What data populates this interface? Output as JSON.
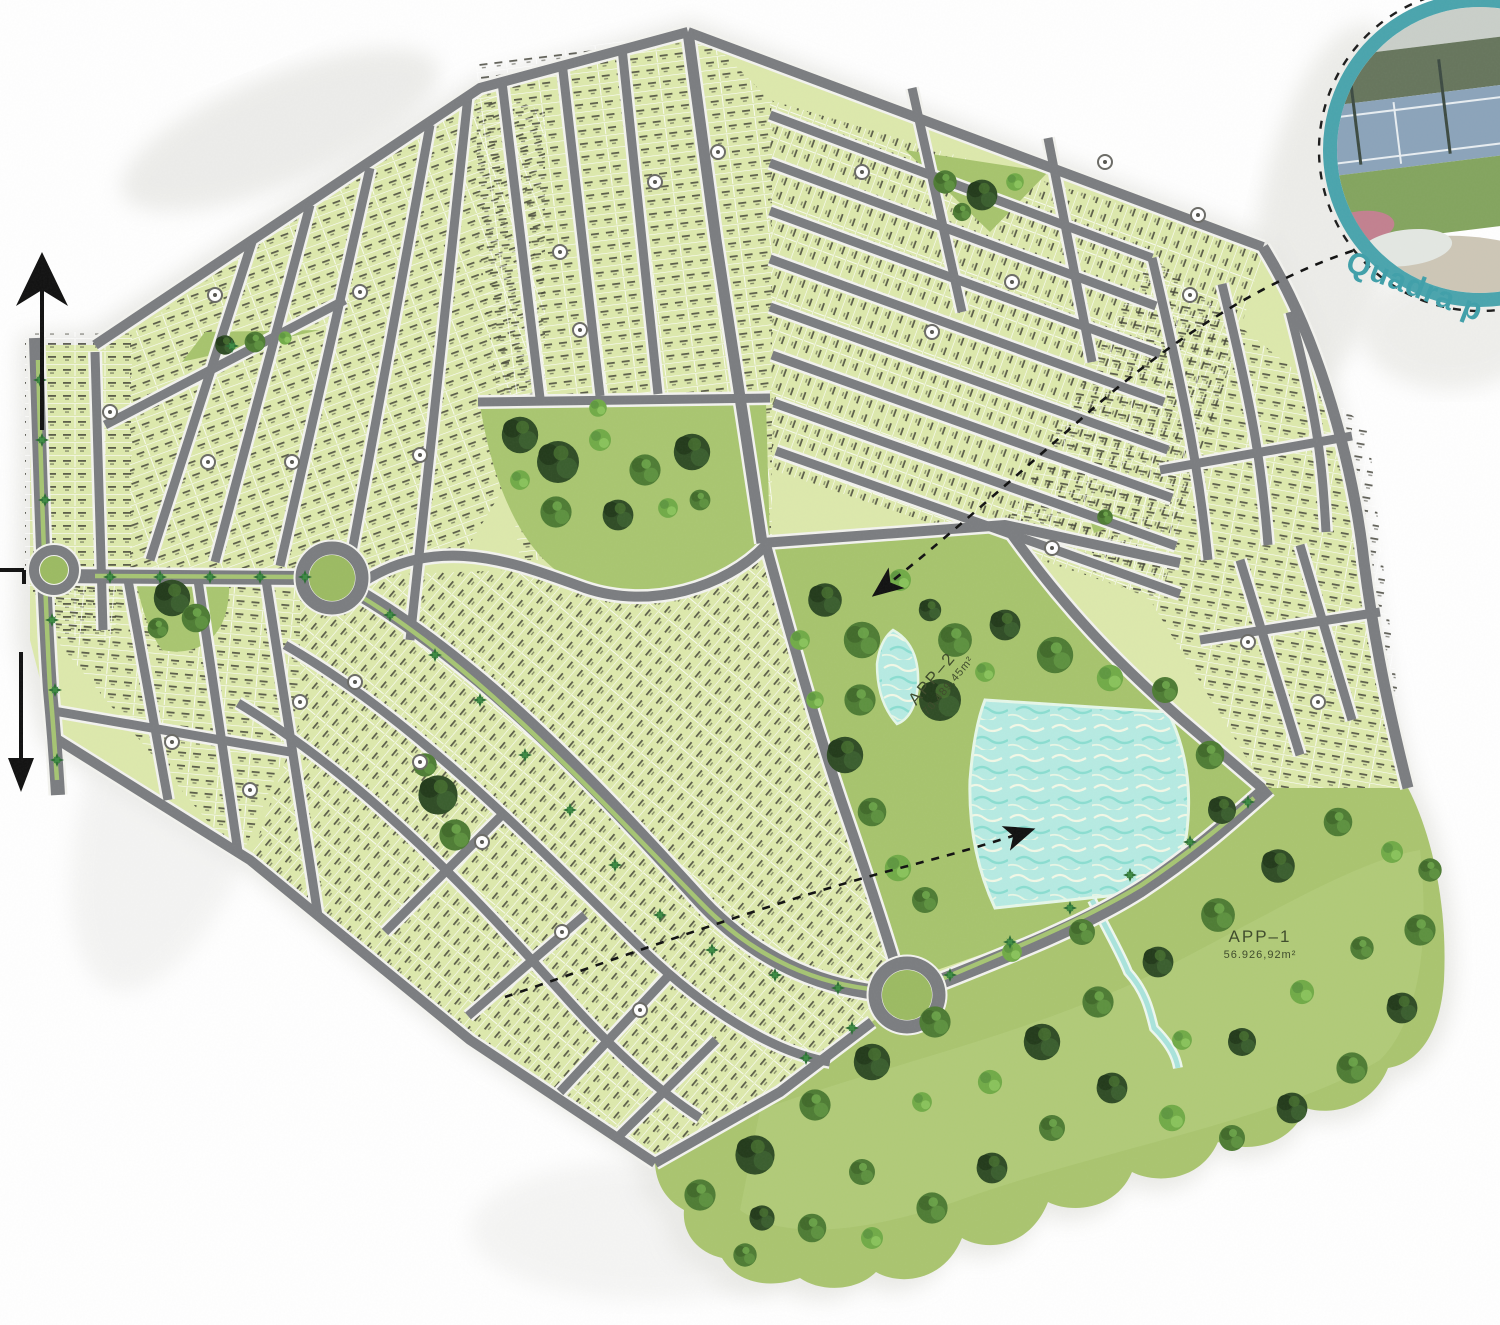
{
  "map": {
    "app_areas": [
      {
        "id": "app2",
        "name": "APP–2",
        "area": "70.489,45m²"
      },
      {
        "id": "app1",
        "name": "APP–1",
        "area": "56.926,92m²"
      }
    ],
    "inset": {
      "caption": "Quadra p"
    },
    "icons": {
      "north_arrow": "north-arrow",
      "exit_arrow": "down-arrow",
      "boundary_tick": "tick-arrow",
      "leader_quadra": "dashed-arrow",
      "leader_lake": "dashed-arrow"
    },
    "colors": {
      "lot_block": "#dde9ac",
      "road": "#7b7d80",
      "road_edge": "#f3f3ef",
      "park": "#a7c46d",
      "park_light": "#b6cf80",
      "water": "#b7ebe3",
      "teal_accent": "#45a1ab",
      "tree_dark": "#2f4c25",
      "tree_mid": "#4e7c34",
      "tree_light": "#71ab47",
      "median_green": "#a6c573"
    }
  }
}
